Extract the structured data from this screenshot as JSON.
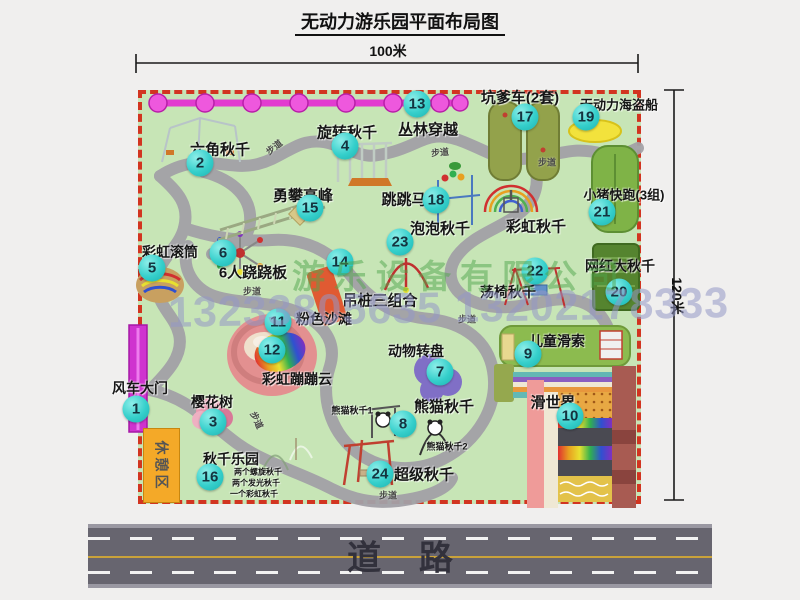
{
  "title": "无动力游乐园平面布局图",
  "dimensions": {
    "top": "100米",
    "right": "120米"
  },
  "road": {
    "label": "道    路"
  },
  "watermark": {
    "company": "游乐设备有限公司",
    "phone": "13233805635 13202178333"
  },
  "rest_area_label": "休憩区",
  "colors": {
    "map_green": "#c7e5b6",
    "border_red": "#d23420",
    "marker_teal": "#35cfcb",
    "gate_magenta": "#cf33cf",
    "rest_orange": "#f4a928",
    "road_gray": "#67656f",
    "chain_pink": "#e23bd0",
    "path_gray": "#a3a1a7"
  },
  "attractions": [
    {
      "num": 1,
      "name": "风车大门",
      "marker": {
        "x": 136,
        "y": 409
      },
      "label": {
        "x": 140,
        "y": 388,
        "fs": 14
      }
    },
    {
      "num": 2,
      "name": "六角秋千",
      "marker": {
        "x": 200,
        "y": 163
      },
      "label": {
        "x": 220,
        "y": 149,
        "fs": 15
      }
    },
    {
      "num": 3,
      "name": "樱花树",
      "marker": {
        "x": 213,
        "y": 422
      },
      "label": {
        "x": 212,
        "y": 402,
        "fs": 14
      }
    },
    {
      "num": 4,
      "name": "旋转秋千",
      "marker": {
        "x": 345,
        "y": 146
      },
      "label": {
        "x": 347,
        "y": 132,
        "fs": 15
      }
    },
    {
      "num": 5,
      "name": "彩虹滚筒",
      "marker": {
        "x": 152,
        "y": 268
      },
      "label": {
        "x": 170,
        "y": 252,
        "fs": 14
      }
    },
    {
      "num": 6,
      "name": "6人跷跷板",
      "marker": {
        "x": 223,
        "y": 253
      },
      "label": {
        "x": 253,
        "y": 272,
        "fs": 15
      }
    },
    {
      "num": 7,
      "name": "动物转盘",
      "marker": {
        "x": 440,
        "y": 372
      },
      "label": {
        "x": 416,
        "y": 351,
        "fs": 14
      }
    },
    {
      "num": 8,
      "name": "熊猫秋千",
      "marker": {
        "x": 403,
        "y": 424
      },
      "label": {
        "x": 444,
        "y": 406,
        "fs": 15
      }
    },
    {
      "num": 9,
      "name": "儿童滑索",
      "marker": {
        "x": 528,
        "y": 354
      },
      "label": {
        "x": 557,
        "y": 341,
        "fs": 14
      }
    },
    {
      "num": 10,
      "name": "滑世界",
      "marker": {
        "x": 570,
        "y": 416
      },
      "label": {
        "x": 553,
        "y": 402,
        "fs": 15
      }
    },
    {
      "num": 11,
      "name": "粉色沙滩",
      "marker": {
        "x": 278,
        "y": 322
      },
      "label": {
        "x": 324,
        "y": 319,
        "fs": 14
      }
    },
    {
      "num": 12,
      "name": "彩虹蹦蹦云",
      "marker": {
        "x": 272,
        "y": 350
      },
      "label": {
        "x": 297,
        "y": 379,
        "fs": 14
      }
    },
    {
      "num": 13,
      "name": "丛林穿越",
      "marker": {
        "x": 417,
        "y": 104
      },
      "label": {
        "x": 428,
        "y": 129,
        "fs": 15
      }
    },
    {
      "num": 14,
      "name": "吊桩三组合",
      "marker": {
        "x": 340,
        "y": 262
      },
      "label": {
        "x": 380,
        "y": 300,
        "fs": 15
      }
    },
    {
      "num": 15,
      "name": "勇攀高峰",
      "marker": {
        "x": 310,
        "y": 208
      },
      "label": {
        "x": 303,
        "y": 195,
        "fs": 15
      }
    },
    {
      "num": 16,
      "name": "秋千乐园",
      "marker": {
        "x": 210,
        "y": 477
      },
      "label": {
        "x": 231,
        "y": 459,
        "fs": 14
      }
    },
    {
      "num": 17,
      "name": "坑爹车(2套)",
      "marker": {
        "x": 525,
        "y": 117
      },
      "label": {
        "x": 520,
        "y": 97,
        "fs": 15
      }
    },
    {
      "num": 18,
      "name": "跳跳马",
      "marker": {
        "x": 436,
        "y": 200
      },
      "label": {
        "x": 404,
        "y": 199,
        "fs": 15
      }
    },
    {
      "num": 19,
      "name": "无动力海盗船",
      "marker": {
        "x": 586,
        "y": 117
      },
      "label": {
        "x": 619,
        "y": 104,
        "fs": 13
      }
    },
    {
      "num": 20,
      "name": "网红大秋千",
      "marker": {
        "x": 619,
        "y": 292
      },
      "label": {
        "x": 620,
        "y": 266,
        "fs": 14
      }
    },
    {
      "num": 21,
      "name": "小猪快跑(3组)",
      "marker": {
        "x": 602,
        "y": 212
      },
      "label": {
        "x": 624,
        "y": 194,
        "fs": 13
      }
    },
    {
      "num": 22,
      "name": "荡椅秋千",
      "marker": {
        "x": 535,
        "y": 271
      },
      "label": {
        "x": 508,
        "y": 292,
        "fs": 14
      }
    },
    {
      "num": 23,
      "name": "泡泡秋千",
      "marker": {
        "x": 400,
        "y": 242
      },
      "label": {
        "x": 440,
        "y": 228,
        "fs": 15
      }
    },
    {
      "num": 24,
      "name": "超级秋千",
      "marker": {
        "x": 380,
        "y": 474
      },
      "label": {
        "x": 424,
        "y": 474,
        "fs": 15
      }
    }
  ],
  "extra_labels": [
    {
      "text": "彩虹秋千",
      "x": 536,
      "y": 226,
      "fs": 15
    },
    {
      "text": "熊猫秋千1",
      "x": 352,
      "y": 410,
      "fs": 9
    },
    {
      "text": "熊猫秋千2",
      "x": 447,
      "y": 446,
      "fs": 9
    },
    {
      "text": "两个螺旋秋千",
      "x": 258,
      "y": 472,
      "fs": 8
    },
    {
      "text": "两个发光秋千",
      "x": 256,
      "y": 483,
      "fs": 8
    },
    {
      "text": "一个彩虹秋千",
      "x": 254,
      "y": 494,
      "fs": 8
    }
  ],
  "walkway_labels": {
    "text": "步道",
    "positions": [
      {
        "x": 274,
        "y": 147,
        "rot": -38
      },
      {
        "x": 440,
        "y": 152,
        "rot": -5
      },
      {
        "x": 547,
        "y": 162,
        "rot": 0
      },
      {
        "x": 252,
        "y": 291,
        "rot": 0
      },
      {
        "x": 467,
        "y": 319,
        "rot": 0
      },
      {
        "x": 388,
        "y": 495,
        "rot": 0
      },
      {
        "x": 257,
        "y": 420,
        "rot": 65
      }
    ]
  }
}
